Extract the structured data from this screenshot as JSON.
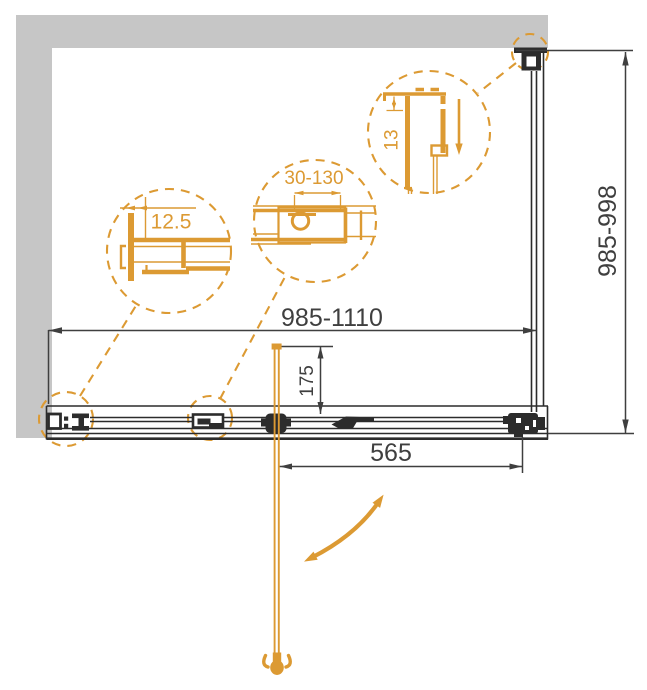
{
  "dimensions": {
    "width_range": "985-1110",
    "depth_range": "985-998",
    "door_inset": "175",
    "door_width": "565"
  },
  "details": {
    "wall_profile_gap": "12.5",
    "adjustment_range": "30-130",
    "top_profile_gap": "13"
  },
  "colors": {
    "accent_orange": "#DC9A33",
    "wall_gray": "#C6C6C6",
    "line_dark": "#2C2C2C",
    "dim_text": "#3F3F3F"
  },
  "icons": {
    "door_swing_arrow": "curved-double-arrow",
    "slide_direction_arrow": "down-arrow"
  }
}
